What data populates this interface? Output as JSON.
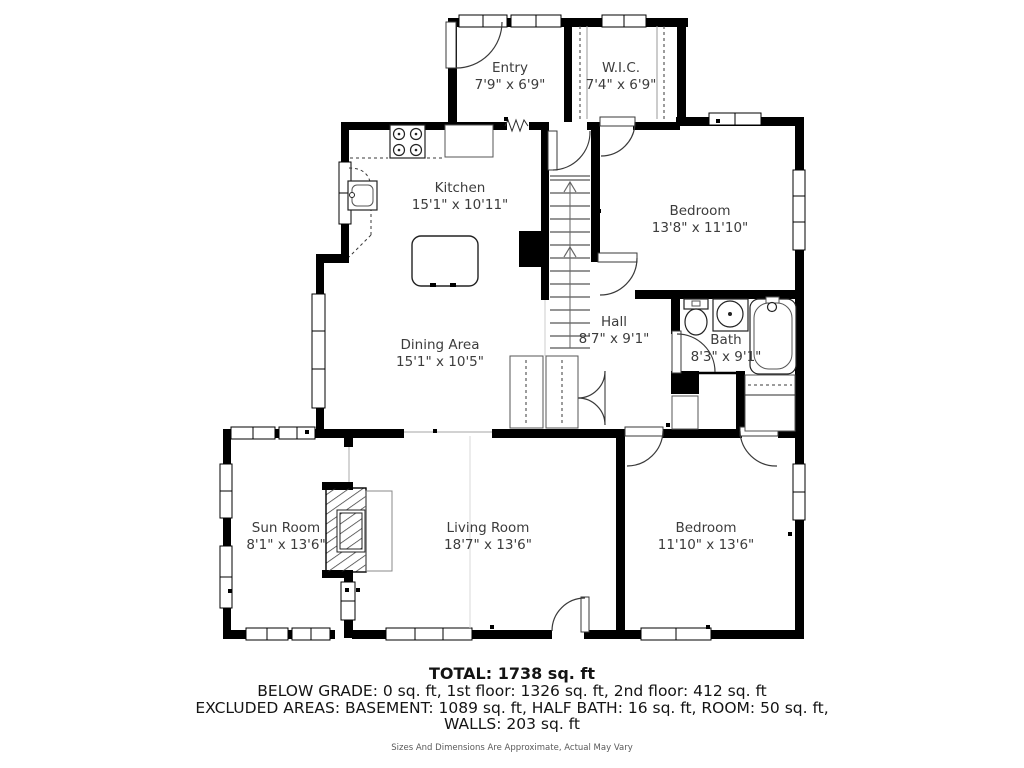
{
  "plan": {
    "rooms": [
      {
        "id": "entry",
        "name": "Entry",
        "dims": "7'9\" x 6'9\""
      },
      {
        "id": "wic",
        "name": "W.I.C.",
        "dims": "7'4\" x 6'9\""
      },
      {
        "id": "kitchen",
        "name": "Kitchen",
        "dims": "15'1\" x 10'11\""
      },
      {
        "id": "bedroom1",
        "name": "Bedroom",
        "dims": "13'8\" x 11'10\""
      },
      {
        "id": "hall",
        "name": "Hall",
        "dims": "8'7\" x 9'1\""
      },
      {
        "id": "bath",
        "name": "Bath",
        "dims": "8'3\" x 9'1\""
      },
      {
        "id": "dining",
        "name": "Dining Area",
        "dims": "15'1\" x 10'5\""
      },
      {
        "id": "sunroom",
        "name": "Sun Room",
        "dims": "8'1\" x 13'6\""
      },
      {
        "id": "living",
        "name": "Living Room",
        "dims": "18'7\" x 13'6\""
      },
      {
        "id": "bedroom2",
        "name": "Bedroom",
        "dims": "11'10\" x 13'6\""
      }
    ],
    "summary": {
      "total": "TOTAL: 1738 sq. ft",
      "line1": "BELOW GRADE: 0 sq. ft, 1st floor: 1326 sq. ft, 2nd floor: 412 sq. ft",
      "line2": "EXCLUDED AREAS: BASEMENT: 1089 sq. ft, HALF BATH: 16 sq. ft, ROOM: 50 sq. ft,",
      "line3": "WALLS: 203 sq. ft",
      "disclaimer": "Sizes And Dimensions Are Approximate, Actual May Vary"
    },
    "colors": {
      "wall": "#000000",
      "label": "#3c3c3c",
      "disclaimer": "#5a5a5a"
    }
  }
}
